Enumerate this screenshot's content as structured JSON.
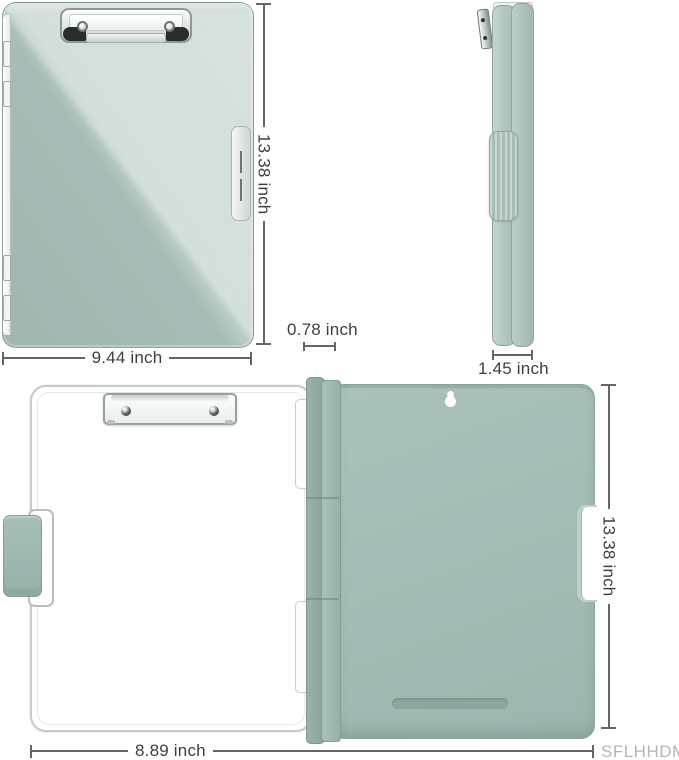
{
  "brand": {
    "label": "SFLHHDM",
    "color": "#b3b6b5"
  },
  "annotations": {
    "closed_height": "13.38 inch",
    "closed_width": "9.44 inch",
    "side_thickness": "1.45 inch",
    "spine_thickness": "0.78 inch",
    "open_height": "13.38 inch",
    "open_width": "8.89 inch"
  },
  "product": {
    "item": "clipboard storage case",
    "views": [
      "closed-front",
      "side-profile",
      "open-inside"
    ],
    "colors": {
      "shell_green": "#a7bcb6",
      "shell_highlight": "#cbdad5",
      "back_panel_green": "#a2bbb4",
      "spine_green": "#89a39c",
      "clip_chrome": "#e9edec",
      "page_white": "#ffffff",
      "dimension_text": "#3f3f3f",
      "dimension_line": "#666666",
      "brand_text": "#b3b6b5"
    }
  }
}
